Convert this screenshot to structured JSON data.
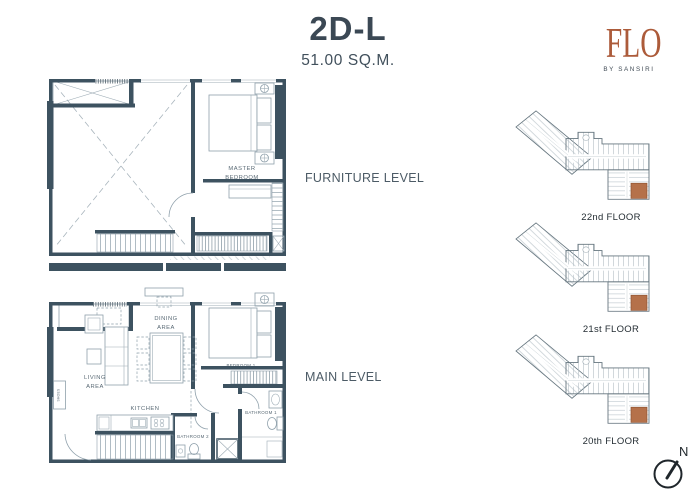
{
  "header": {
    "unit_name": "2D-L",
    "unit_area": "51.00 SQ.M."
  },
  "brand": {
    "name": "FLO",
    "byline": "BY SANSIRI"
  },
  "plans": {
    "furniture_level": {
      "section_label": "FURNITURE LEVEL",
      "rooms": {
        "master_bedroom": [
          "MASTER",
          "BEDROOM"
        ]
      }
    },
    "main_level": {
      "section_label": "MAIN LEVEL",
      "rooms": {
        "living": [
          "LIVING",
          "AREA"
        ],
        "dining": [
          "DINING",
          "AREA"
        ],
        "kitchen": "KITCHEN",
        "bedroom1": "BEDROOM 1",
        "bathroom1": "BATHROOM 1",
        "bathroom2": "BATHROOM 2",
        "shoes": "SHOES"
      }
    }
  },
  "key_plans": [
    {
      "floor_label": "22nd FLOOR"
    },
    {
      "floor_label": "21st FLOOR"
    },
    {
      "floor_label": "20th FLOOR"
    }
  ],
  "compass": {
    "north": "N"
  },
  "colors": {
    "wall_dark": "#3d5260",
    "line_light": "#8fa0ab",
    "brand_rust": "#ac5b3a",
    "unit_highlight": "#b5714a",
    "title_text": "#3b4854",
    "label_text": "#4c5b66"
  }
}
